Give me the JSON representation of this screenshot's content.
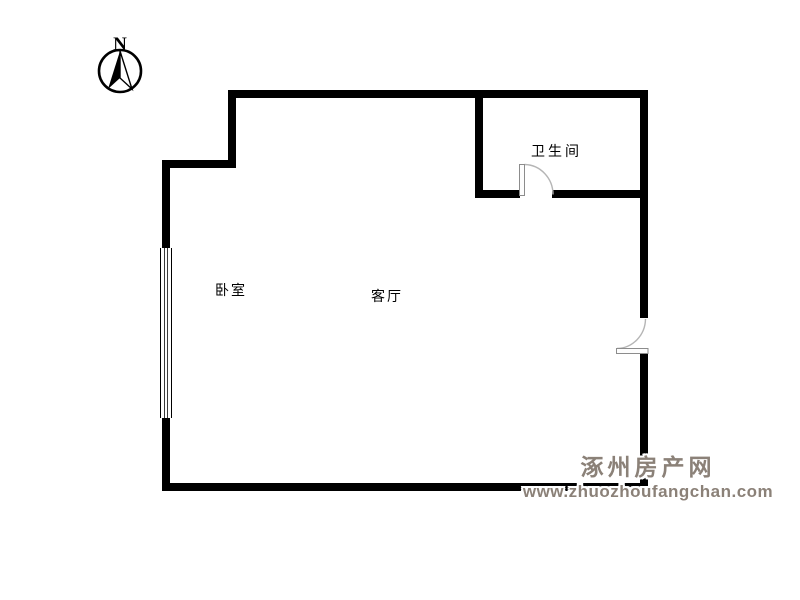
{
  "page": {
    "background": "#ffffff"
  },
  "palette": {
    "wall": "#000000",
    "door_arc": "#b5b5b5",
    "door_leaf_border": "#8c8c8c",
    "label_text": "#000000",
    "watermark_text": "#8b8178"
  },
  "compass": {
    "label": "N"
  },
  "rooms": {
    "bedroom": {
      "label": "卧室"
    },
    "living_room": {
      "label": "客厅"
    },
    "bathroom": {
      "label": "卫生间"
    }
  },
  "watermark": {
    "site_name": "涿州房产网",
    "site_url": "www.zhuozhoufangchan.com"
  }
}
